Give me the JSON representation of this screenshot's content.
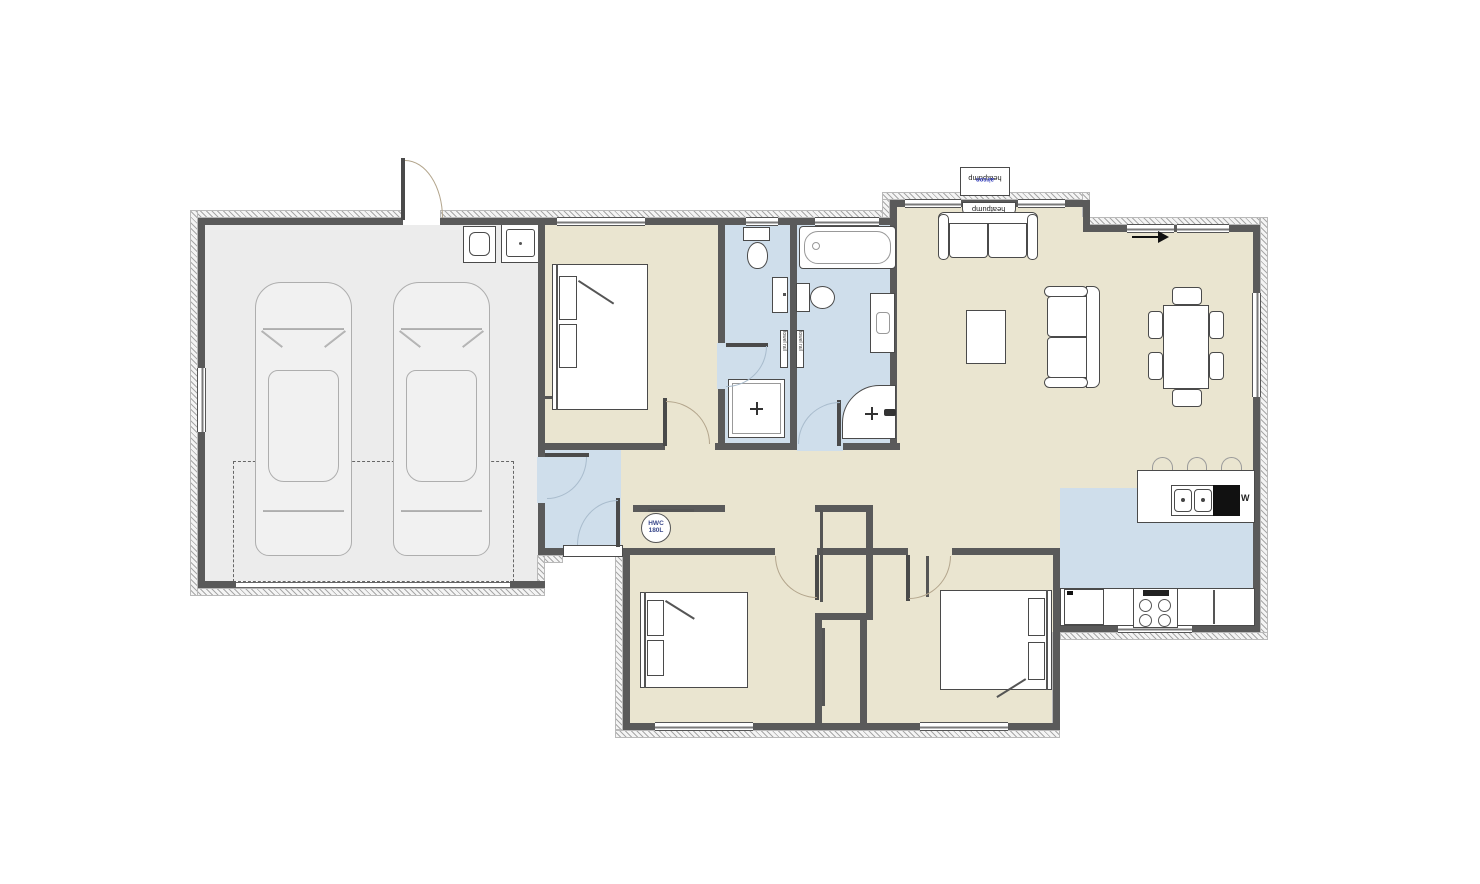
{
  "labels": {
    "heatpump_indoor": "heatpump",
    "heatpump_outdoor": "heatpump",
    "heatpump_outdoor_type": "aircon",
    "hwc_top": "HWC",
    "hwc_bottom": "180L",
    "dishwasher": "W",
    "towel_rail_ensuite": "towel rail",
    "towel_rail_bathroom": "towel rail"
  },
  "colors": {
    "wall": "#5a5a5a",
    "floor_main": "#eae5d0",
    "floor_wet": "#cfdeeb",
    "floor_garage": "#ececec",
    "label_blue": "#2a35b8",
    "hwc_text": "#3b4a8c",
    "furniture_line": "#4a4a4a"
  }
}
